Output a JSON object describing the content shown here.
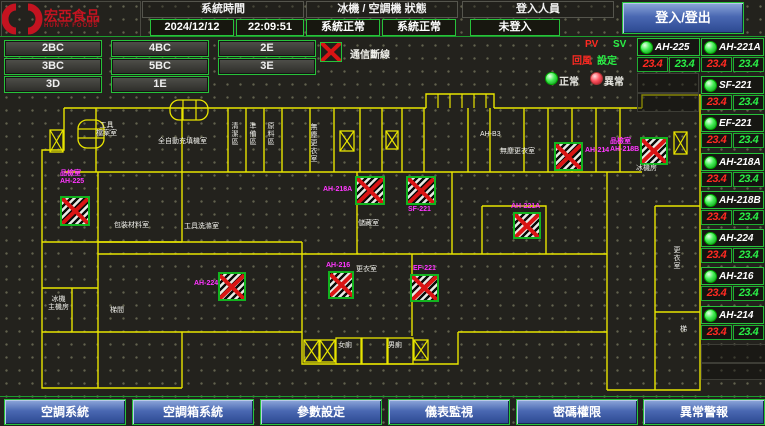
{
  "header": {
    "logo_text": "宏亞食品",
    "logo_sub": "HUNYA FOODS",
    "time_label": "系統時間",
    "date": "2024/12/12",
    "time": "22:09:51",
    "status_label": "冰機 / 空調機 狀態",
    "status_left": "系統正常",
    "status_right": "系統正常",
    "login_label": "登入人員",
    "login_value": "未登入",
    "login_button": "登入/登出"
  },
  "zones": [
    "2BC",
    "4BC",
    "2E",
    "3BC",
    "5BC",
    "3E",
    "3D",
    "1E"
  ],
  "legend": {
    "comm_broken": "通信斷線",
    "pv": "PV",
    "sv": "SV",
    "pv_desc": "回風",
    "sv_desc": "設定",
    "normal": "正常",
    "abnormal": "異常"
  },
  "units": {
    "col_a": [
      {
        "name": "AH-225",
        "pv": "23.4",
        "sv": "23.4"
      }
    ],
    "col_b": [
      {
        "name": "AH-221A",
        "pv": "23.4",
        "sv": "23.4"
      },
      {
        "name": "SF-221",
        "pv": "23.4",
        "sv": "23.4"
      },
      {
        "name": "EF-221",
        "pv": "23.4",
        "sv": "23.4"
      },
      {
        "name": "AH-218A",
        "pv": "23.4",
        "sv": "23.4"
      },
      {
        "name": "AH-218B",
        "pv": "23.4",
        "sv": "23.4"
      },
      {
        "name": "AH-224",
        "pv": "23.4",
        "sv": "23.4"
      },
      {
        "name": "AH-216",
        "pv": "23.4",
        "sv": "23.4"
      },
      {
        "name": "AH-214",
        "pv": "23.4",
        "sv": "23.4"
      }
    ]
  },
  "plan": {
    "markers": [
      {
        "name": "AH-225",
        "label": "品檢室\nAH-225"
      },
      {
        "name": "AH-218A",
        "label": "AH-218A"
      },
      {
        "name": "SF-221",
        "label": "SF-221"
      },
      {
        "name": "AH-214",
        "label": "AH-214"
      },
      {
        "name": "AH-218B",
        "label": "品檢室\nAH-218B"
      },
      {
        "name": "AH-221A",
        "label": "AH-221A"
      },
      {
        "name": "EF-221",
        "label": "EF-221"
      },
      {
        "name": "AH-224",
        "label": "AH-224"
      },
      {
        "name": "AH-216",
        "label": "AH-216"
      }
    ],
    "room_labels": [
      "工具\n檔案室",
      "全自動充填機室",
      "清潔區",
      "準備區",
      "原料區",
      "無塵更衣室",
      "AH-B3",
      "無塵更衣室",
      "包裝材料室",
      "工具洗滌室",
      "儲藏室",
      "更衣室",
      "冰機\n主機房",
      "梯間",
      "女廁",
      "男廁",
      "更衣室",
      "梯",
      "冰機房"
    ]
  },
  "footer": [
    "空調系統",
    "空調箱系統",
    "參數設定",
    "儀表監視",
    "密碼權限",
    "異常警報"
  ],
  "colors": {
    "wall_yellow": "#e8e400",
    "accent_green": "#27c23a",
    "alarm_red": "#da1414",
    "tag_magenta": "#ff35ff",
    "pv_red": "#ff2a22",
    "sv_green": "#2aee46",
    "button_blue": "#4a68b2"
  }
}
